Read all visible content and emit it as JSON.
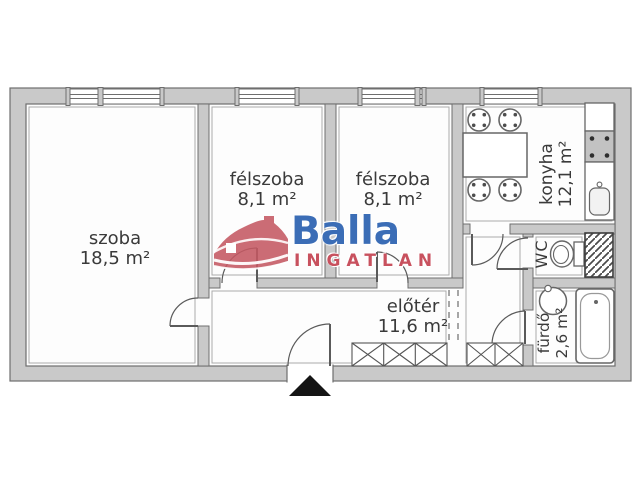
{
  "plan": {
    "wall_color": "#c9c9c9",
    "line_color": "#5f5f5f",
    "text_color": "#3a3a3a",
    "rooms": {
      "szoba": {
        "name": "szoba",
        "area": "18,5 m²"
      },
      "felszoba1": {
        "name": "félszoba",
        "area": "8,1 m²"
      },
      "felszoba2": {
        "name": "félszoba",
        "area": "8,1 m²"
      },
      "konyha": {
        "name": "konyha",
        "area": "12,1 m²"
      },
      "wc": {
        "name": "WC"
      },
      "eloter": {
        "name": "előtér",
        "area": "11,6 m²"
      },
      "furdo": {
        "name": "fürdő",
        "area": "2,6 m²"
      }
    }
  },
  "logo": {
    "brand": "Balla",
    "subtitle": "INGATLAN",
    "brand_color": "#3b6db6",
    "subtitle_color": "#c8515e",
    "house_color": "#c45862"
  }
}
